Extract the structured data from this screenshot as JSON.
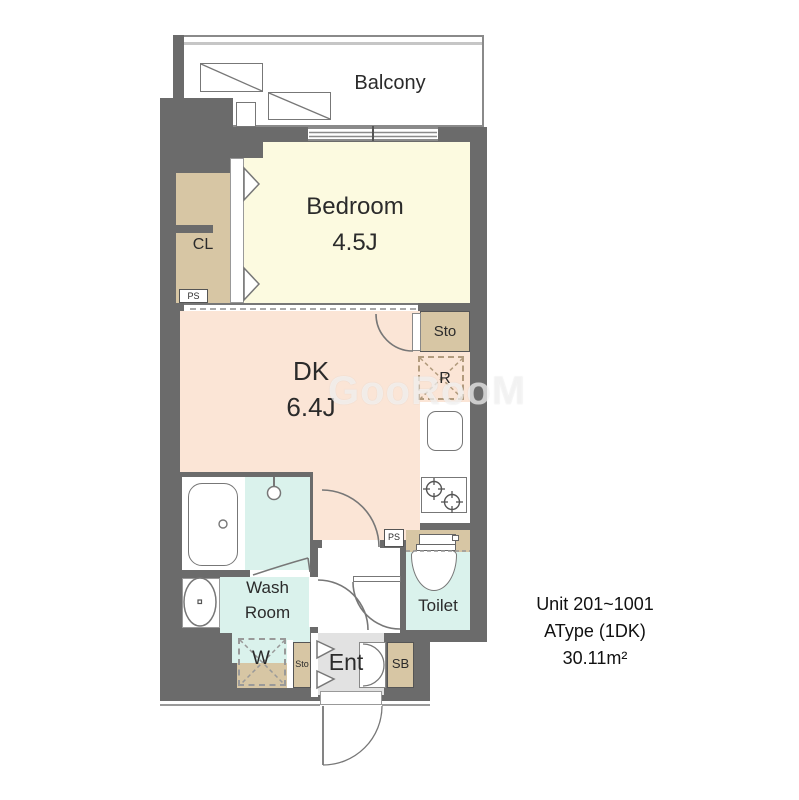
{
  "floorplan": {
    "balcony": {
      "label": "Balcony"
    },
    "bedroom": {
      "label": "Bedroom",
      "size": "4.5J"
    },
    "closet": {
      "label": "CL"
    },
    "ps_upper": {
      "label": "PS"
    },
    "storage_upper": {
      "label": "Sto"
    },
    "refrigerator": {
      "label": "R"
    },
    "dining_kitchen": {
      "label": "DK",
      "size": "6.4J"
    },
    "wash_room": {
      "line1": "Wash",
      "line2": "Room"
    },
    "washer": {
      "label": "W"
    },
    "storage_lower": {
      "label": "Sto"
    },
    "entrance": {
      "label": "Ent"
    },
    "shoe_box": {
      "label": "SB"
    },
    "toilet": {
      "label": "Toilet"
    },
    "ps_lower": {
      "label": "PS"
    }
  },
  "info": {
    "line1": "Unit 201~1001",
    "line2": "AType (1DK)",
    "line3": "30.11m²"
  },
  "watermark": "GooRooM",
  "colors": {
    "wall": "#6b6b6b",
    "bedroom_floor": "#fcfae0",
    "dk_floor": "#fbe5d6",
    "wet_area_floor": "#daf2ec",
    "closet_fill": "#d7c6a4",
    "entrance_floor": "#e2e2e2",
    "fixture_line": "#777777",
    "refrigerator_dash": "#b29b7d"
  }
}
